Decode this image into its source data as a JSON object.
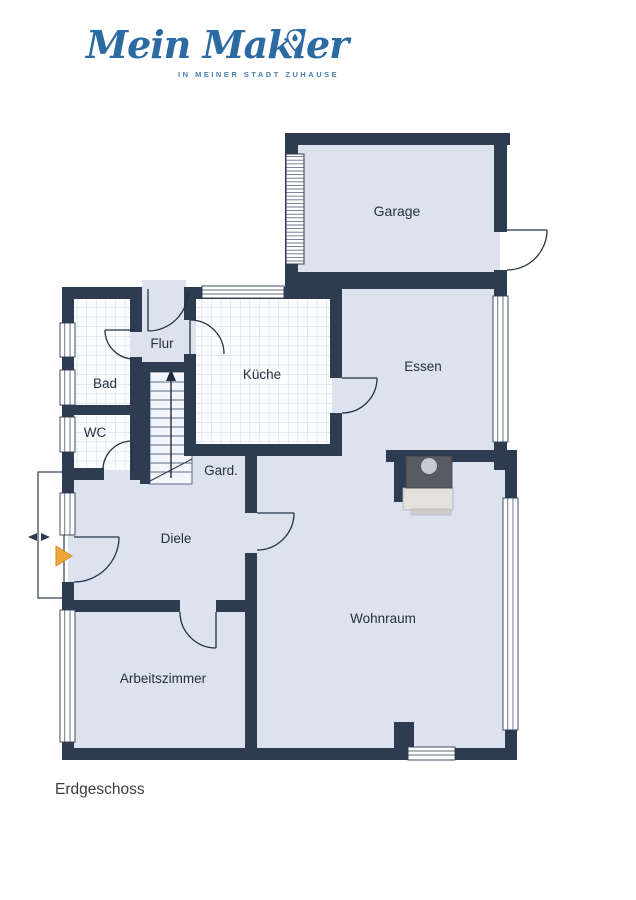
{
  "logo": {
    "brand": "Mein Makler",
    "tagline": "IN MEINER STADT ZUHAUSE"
  },
  "title": "Erdgeschoss",
  "floor_plan": {
    "rooms": [
      {
        "id": "garage",
        "label": "Garage"
      },
      {
        "id": "flur",
        "label": "Flur"
      },
      {
        "id": "bad",
        "label": "Bad"
      },
      {
        "id": "wc",
        "label": "WC"
      },
      {
        "id": "kueche",
        "label": "Küche"
      },
      {
        "id": "essen",
        "label": "Essen"
      },
      {
        "id": "garderobe",
        "label": "Gard."
      },
      {
        "id": "diele",
        "label": "Diele"
      },
      {
        "id": "wohnraum",
        "label": "Wohnraum"
      },
      {
        "id": "arbeitszimmer",
        "label": "Arbeitszimmer"
      }
    ],
    "features": [
      "staircase-up-arrow",
      "fireplace",
      "entrance-arrow",
      "garage-roller-door",
      "entrance-porch"
    ],
    "colors": {
      "wall": "#2e3c52",
      "floor": "#dce3ef",
      "tile_line": "#c9d6e7",
      "stair_floor": "#eef2f8",
      "entrance_arrow": "#f0a43c",
      "fireplace_body": "#595a60",
      "fireplace_base": "#e3e1db",
      "logo_blue": "#2b6aa2"
    }
  }
}
